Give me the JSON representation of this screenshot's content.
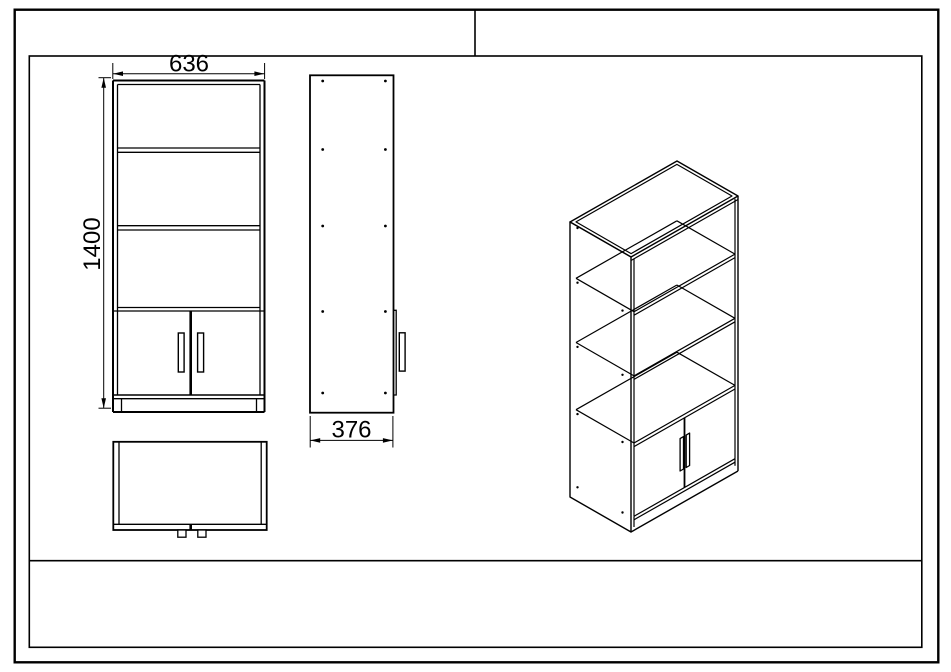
{
  "drawing": {
    "front_view": {
      "width_dim": "636",
      "height_dim": "1400"
    },
    "side_view": {
      "depth_dim": "376"
    }
  }
}
